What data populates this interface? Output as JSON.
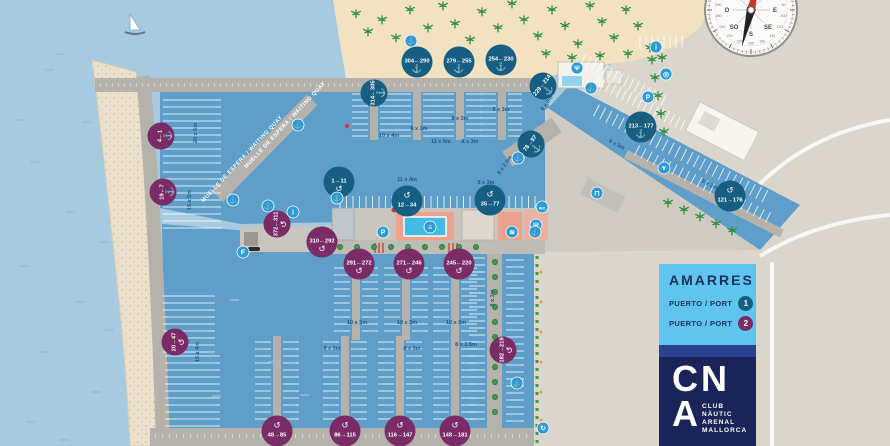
{
  "palette": {
    "open_sea": "#A6CBE0",
    "marina_water": "#5E9EC9",
    "sand": "#F3E2C2",
    "land": "#DBD6CC",
    "quay": "#B5B2AC",
    "breakwater": "#EAE0CC",
    "port1": "#175F82",
    "port2": "#7A2C66",
    "icon_blue": "#2D9CD6",
    "tree_green": "#3E9B47",
    "dim_text": "#1D5C8C",
    "legend_bg": "#5FC4EE",
    "navy": "#1B2F5E"
  },
  "map": {
    "quay_labels": [
      {
        "text": "MUELLE DE ESPERA / WAITING QUAY",
        "x": 286,
        "y": 126,
        "angle": -47
      },
      {
        "text": "MUELLE DE ESPERA / WAITING QUAY",
        "x": 243,
        "y": 160,
        "angle": -47
      }
    ],
    "dimension_labels": [
      {
        "text": "20 x 6m",
        "x": 197,
        "y": 133,
        "a": -90
      },
      {
        "text": "15 x 5m",
        "x": 191,
        "y": 200,
        "a": -90
      },
      {
        "text": "15 x 4m",
        "x": 199,
        "y": 352,
        "a": -90
      },
      {
        "text": "10 x 4m",
        "x": 389,
        "y": 137,
        "a": 0
      },
      {
        "text": "8 x 3m",
        "x": 419,
        "y": 130,
        "a": 0
      },
      {
        "text": "8 x 3m",
        "x": 460,
        "y": 120,
        "a": 0
      },
      {
        "text": "8 x 3m",
        "x": 501,
        "y": 111,
        "a": 0
      },
      {
        "text": "11 x 6m",
        "x": 441,
        "y": 143,
        "a": 0
      },
      {
        "text": "8 x 3m",
        "x": 470,
        "y": 143,
        "a": 0
      },
      {
        "text": "11 x 4m",
        "x": 407,
        "y": 181,
        "a": 0
      },
      {
        "text": "8 x 3m",
        "x": 486,
        "y": 184,
        "a": 0
      },
      {
        "text": "8 x 2.5m",
        "x": 506,
        "y": 166,
        "a": -55
      },
      {
        "text": "8 x 3m",
        "x": 548,
        "y": 104,
        "a": -55
      },
      {
        "text": "8 x 3m",
        "x": 616,
        "y": 146,
        "a": 27
      },
      {
        "text": "5 x 2m",
        "x": 709,
        "y": 186,
        "a": 27
      },
      {
        "text": "8 x 3m",
        "x": 494,
        "y": 298,
        "a": -90
      },
      {
        "text": "10 x 3m",
        "x": 357,
        "y": 324,
        "a": 0
      },
      {
        "text": "10 x 3m",
        "x": 407,
        "y": 324,
        "a": 0
      },
      {
        "text": "10 x 3m",
        "x": 456,
        "y": 324,
        "a": 0
      },
      {
        "text": "8 x 3m",
        "x": 332,
        "y": 350,
        "a": 0
      },
      {
        "text": "8 x 3m",
        "x": 412,
        "y": 350,
        "a": 0
      },
      {
        "text": "8 x 2.5m",
        "x": 466,
        "y": 346,
        "a": 0
      }
    ],
    "berth_badges": [
      {
        "label": "314←305",
        "port": 1,
        "x": 374,
        "y": 93,
        "angle": -90,
        "glyph": "anchor",
        "gpos": "bottom"
      },
      {
        "label": "304←290",
        "port": 1,
        "x": 417,
        "y": 62,
        "angle": 0,
        "glyph": "anchor",
        "gpos": "bottom"
      },
      {
        "label": "279←255",
        "port": 1,
        "x": 459,
        "y": 62,
        "angle": 0,
        "glyph": "anchor",
        "gpos": "bottom"
      },
      {
        "label": "254←230",
        "port": 1,
        "x": 501,
        "y": 60,
        "angle": 0,
        "glyph": "anchor",
        "gpos": "bottom"
      },
      {
        "label": "229←214",
        "port": 1,
        "x": 543,
        "y": 86,
        "angle": -52,
        "glyph": "anchor",
        "gpos": "bottom"
      },
      {
        "label": "213←177",
        "port": 1,
        "x": 641,
        "y": 127,
        "angle": 0,
        "glyph": "anchor",
        "gpos": "bottom"
      },
      {
        "label": "121→176",
        "port": 1,
        "x": 730,
        "y": 196,
        "angle": 0,
        "glyph": "uturn",
        "gpos": "top"
      },
      {
        "label": "78→97",
        "port": 1,
        "x": 531,
        "y": 144,
        "angle": -52,
        "glyph": "anchor",
        "gpos": "bottom"
      },
      {
        "label": "1→11",
        "port": 1,
        "x": 339,
        "y": 182,
        "angle": 0,
        "glyph": "uturn",
        "gpos": "bottom"
      },
      {
        "label": "12→34",
        "port": 1,
        "x": 407,
        "y": 201,
        "angle": 0,
        "glyph": "uturn",
        "gpos": "top"
      },
      {
        "label": "35→77",
        "port": 1,
        "x": 490,
        "y": 200,
        "angle": 0,
        "glyph": "uturn",
        "gpos": "top"
      },
      {
        "label": "4←1",
        "port": 2,
        "x": 161,
        "y": 136,
        "angle": -90,
        "glyph": "anchor",
        "gpos": "bottom"
      },
      {
        "label": "19←7",
        "port": 2,
        "x": 163,
        "y": 192,
        "angle": -90,
        "glyph": "anchor",
        "gpos": "bottom"
      },
      {
        "label": "20→47",
        "port": 2,
        "x": 175,
        "y": 342,
        "angle": -90,
        "glyph": "uturn",
        "gpos": "bottom"
      },
      {
        "label": "48→85",
        "port": 2,
        "x": 277,
        "y": 431,
        "angle": 0,
        "glyph": "uturn",
        "gpos": "top"
      },
      {
        "label": "86→115",
        "port": 2,
        "x": 345,
        "y": 431,
        "angle": 0,
        "glyph": "uturn",
        "gpos": "top"
      },
      {
        "label": "116→147",
        "port": 2,
        "x": 400,
        "y": 431,
        "angle": 0,
        "glyph": "uturn",
        "gpos": "top"
      },
      {
        "label": "148→181",
        "port": 2,
        "x": 455,
        "y": 431,
        "angle": 0,
        "glyph": "uturn",
        "gpos": "top"
      },
      {
        "label": "182→219",
        "port": 2,
        "x": 503,
        "y": 350,
        "angle": -90,
        "glyph": "uturn",
        "gpos": "bottom"
      },
      {
        "label": "245←220",
        "port": 2,
        "x": 459,
        "y": 264,
        "angle": 0,
        "glyph": "uturn",
        "gpos": "bottom"
      },
      {
        "label": "271←246",
        "port": 2,
        "x": 409,
        "y": 264,
        "angle": 0,
        "glyph": "uturn",
        "gpos": "bottom"
      },
      {
        "label": "291←272",
        "port": 2,
        "x": 359,
        "y": 264,
        "angle": 0,
        "glyph": "uturn",
        "gpos": "bottom"
      },
      {
        "label": "310←292",
        "port": 2,
        "x": 322,
        "y": 242,
        "angle": 0,
        "glyph": "uturn",
        "gpos": "bottom"
      },
      {
        "label": "372←311",
        "port": 2,
        "x": 277,
        "y": 224,
        "angle": -90,
        "glyph": "uturn",
        "gpos": "bottom"
      }
    ],
    "amenity_icons": [
      {
        "name": "anchor-icon",
        "glyph": "⚓",
        "x": 411,
        "y": 41
      },
      {
        "name": "info-icon",
        "glyph": "i",
        "x": 656,
        "y": 47
      },
      {
        "name": "restaurant-icon",
        "glyph": "Ψ",
        "x": 577,
        "y": 68
      },
      {
        "name": "lifebuoy-icon",
        "glyph": "◎",
        "x": 666,
        "y": 74
      },
      {
        "name": "anchor-icon",
        "glyph": "⚓",
        "x": 591,
        "y": 88
      },
      {
        "name": "parking-icon",
        "glyph": "P",
        "x": 648,
        "y": 97
      },
      {
        "name": "anchor-icon",
        "glyph": "⚓",
        "x": 298,
        "y": 125
      },
      {
        "name": "anchor-icon",
        "glyph": "⚓",
        "x": 518,
        "y": 158
      },
      {
        "name": "slipway-icon",
        "glyph": "▼",
        "x": 664,
        "y": 168
      },
      {
        "name": "travel-lift-icon",
        "glyph": "⊓",
        "x": 597,
        "y": 193
      },
      {
        "name": "anchor-icon",
        "glyph": "⚓",
        "x": 337,
        "y": 198
      },
      {
        "name": "anchor-icon",
        "glyph": "⚓",
        "x": 233,
        "y": 200
      },
      {
        "name": "wc-icon",
        "glyph": "WC",
        "x": 542,
        "y": 207
      },
      {
        "name": "anchor-icon",
        "glyph": "⚓",
        "x": 268,
        "y": 206
      },
      {
        "name": "info-icon",
        "glyph": "i",
        "x": 293,
        "y": 212
      },
      {
        "name": "restaurant-icon",
        "glyph": "Ψ",
        "x": 536,
        "y": 225
      },
      {
        "name": "pool-ladder-icon",
        "glyph": "≡",
        "x": 430,
        "y": 227
      },
      {
        "name": "parking-icon",
        "glyph": "P",
        "x": 383,
        "y": 232
      },
      {
        "name": "shower-icon",
        "glyph": "≋",
        "x": 512,
        "y": 232
      },
      {
        "name": "anchor-icon",
        "glyph": "⚓",
        "x": 535,
        "y": 232
      },
      {
        "name": "fuel-icon",
        "glyph": "F",
        "x": 243,
        "y": 252
      },
      {
        "name": "anchor-icon",
        "glyph": "⚓",
        "x": 517,
        "y": 383
      },
      {
        "name": "recycling-icon",
        "glyph": "↻",
        "x": 543,
        "y": 428
      }
    ]
  },
  "compass": {
    "cardinals": [
      {
        "label": "N",
        "angle": 0
      },
      {
        "label": "NE",
        "angle": 45
      },
      {
        "label": "E",
        "angle": 90
      },
      {
        "label": "SE",
        "angle": 135
      },
      {
        "label": "S",
        "angle": 180
      },
      {
        "label": "SO",
        "angle": 225
      },
      {
        "label": "O",
        "angle": 270
      },
      {
        "label": "NO",
        "angle": 315
      }
    ],
    "degree_labels": [
      80,
      100,
      120,
      140,
      160,
      180,
      200,
      220,
      240,
      260,
      280
    ]
  },
  "legend": {
    "title": "AMARRES",
    "items": [
      {
        "label": "PUERTO / PORT",
        "number": "1"
      },
      {
        "label": "PUERTO / PORT",
        "number": "2"
      }
    ]
  },
  "logo": {
    "top_letters": "CN",
    "bottom_letter": "A",
    "club_lines": [
      "CLUB",
      "NÀUTIC",
      "ARENAL",
      "MALLORCA"
    ]
  }
}
